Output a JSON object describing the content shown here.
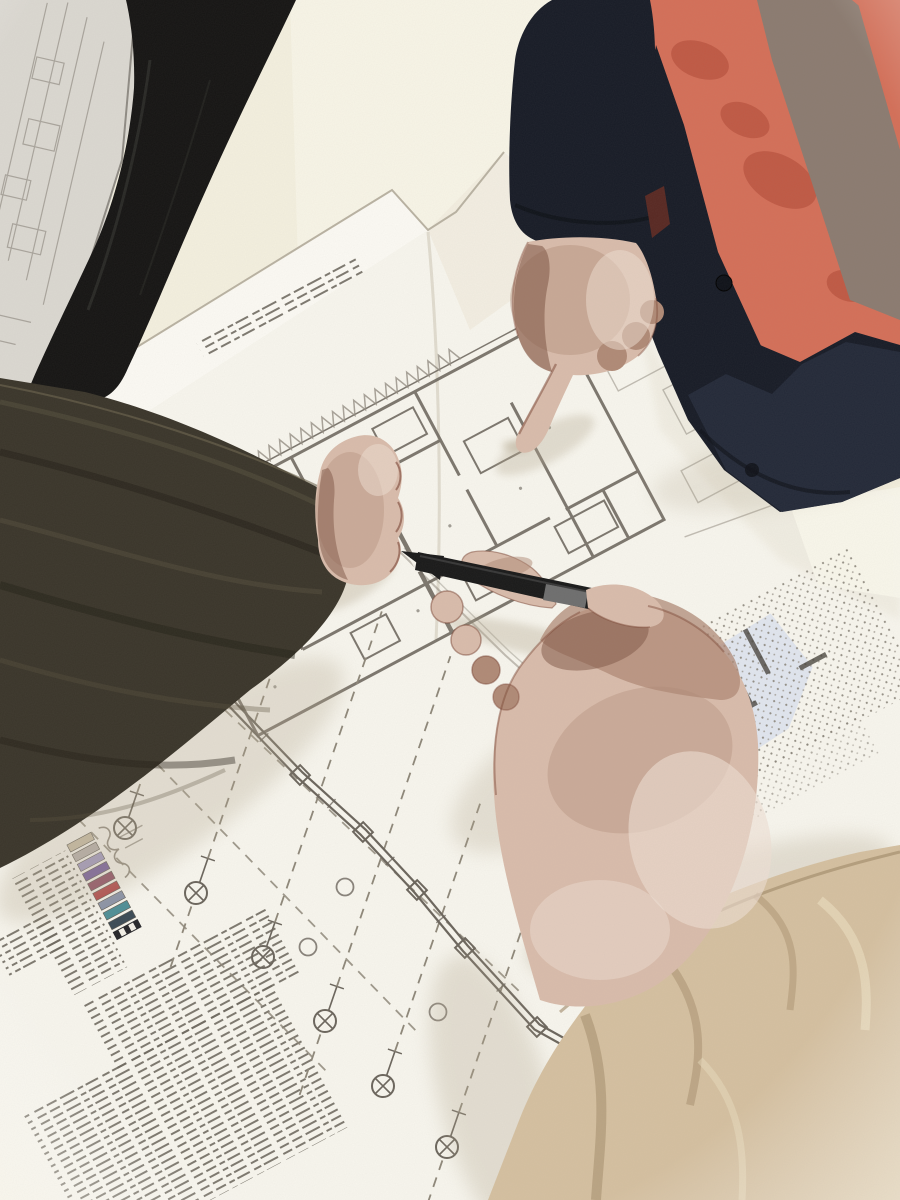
{
  "scene": {
    "description": "Overhead pencil-sketch styled photo: three construction workers lean over large architectural blueprints. A worker in an orange hi-vis vest over a navy jacket points a finger at the floor plan, a left arm in a dark olive sleeve rests a fist on the sheet, and a right hand emerging from a tan puffy coat sleeve holds a black pen over the drawing. The sheet carries floor-plan rooms, dashed grid lines, circled survey markers, a colored legend and dense illegible specification notes.",
    "style": "stylized sketch photograph, no legible text"
  },
  "colors": {
    "bg": "#f4f0df",
    "bg_light": "#faf8ec",
    "sheet": "#f8f6ee",
    "sheet_shade": "#e8e3d4",
    "sheet2": "#dbd8d1",
    "sheet2_line": "#a19c93",
    "line": "#6b655c",
    "line_soft": "#938d82",
    "dash": "#8e8779",
    "navy": "#171b26",
    "navy2": "#232938",
    "navy_dark": "#0e1118",
    "trouser": "#151413",
    "vest_orange": "#d46f58",
    "vest_orange_dark": "#a8402e",
    "vest_stripe": "#8b7b70",
    "olive": "#3a352a",
    "olive_light": "#5c5440",
    "olive_dark": "#221e15",
    "tan": "#d5c0a0",
    "tan_shadow": "#9f8765",
    "tan_light": "#ecdfc2",
    "skin": "#d9bcab",
    "skin_mid": "#b08a76",
    "skin_deep": "#7e5343",
    "skin_light": "#efe0d4",
    "outline": "#7a4434",
    "pen": "#191919",
    "pen_band": "#6e6e6e",
    "blue_zone": "#dde3ee",
    "blue_chip": "#9dc2d8",
    "pink_chip": "#c2427e",
    "shadow": "#b4a78f",
    "maroon": "#5f2a22"
  },
  "plan": {
    "rotation_deg": -28,
    "markers": [
      [
        125,
        828
      ],
      [
        196,
        893
      ],
      [
        263,
        957
      ],
      [
        325,
        1021
      ],
      [
        383,
        1086
      ],
      [
        447,
        1147
      ]
    ],
    "marker_ray_len": [
      320,
      340,
      360,
      380,
      300,
      260
    ],
    "small_circles": [
      [
        345,
        887
      ],
      [
        308,
        947
      ],
      [
        438,
        1012
      ]
    ],
    "service_line": [
      [
        228,
        700
      ],
      [
        300,
        775
      ],
      [
        363,
        832
      ],
      [
        417,
        890
      ],
      [
        465,
        948
      ],
      [
        537,
        1027
      ],
      [
        600,
        1062
      ]
    ],
    "row_dashes": [
      [
        95,
        700,
        420,
        1035
      ],
      [
        28,
        768,
        330,
        1075
      ],
      [
        160,
        648,
        520,
        992
      ]
    ],
    "text_blocks": [
      [
        8,
        790,
        62,
        42
      ],
      [
        60,
        890,
        205,
        78
      ],
      [
        -45,
        958,
        280,
        165
      ],
      [
        56,
        746,
        60,
        132
      ],
      [
        470,
        355,
        180,
        24
      ]
    ],
    "legend_chips": [
      "#c9bda6",
      "#b7b1ac",
      "#a29ac2",
      "#745c9c",
      "#8e4a62",
      "#b24547",
      "#8a93a8",
      "#4f8f96",
      "#3b4a55",
      "#26262a"
    ],
    "legend_pos": [
      120,
      742
    ],
    "zigzag": {
      "x0": 420,
      "x1": 700,
      "y_base": 498,
      "y_peak": 484,
      "step": 12
    }
  }
}
